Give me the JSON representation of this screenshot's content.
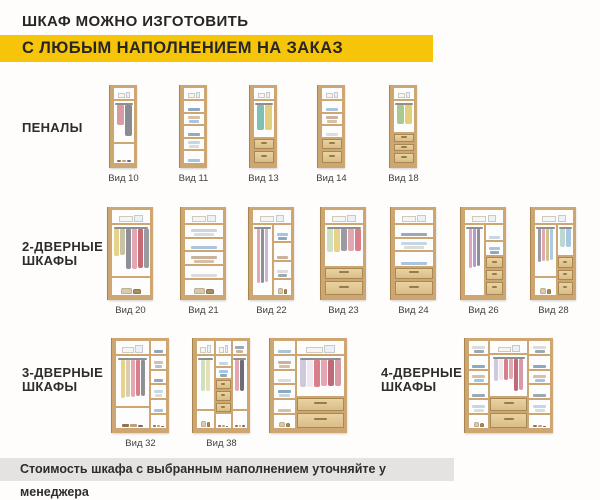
{
  "header": {
    "line1": "ШКАФ МОЖНО ИЗГОТОВИТЬ",
    "line2": "С ЛЮБЫМ НАПОЛНЕНИЕМ НА ЗАКАЗ",
    "highlight_color": "#f6c50a",
    "text_color": "#262626"
  },
  "footer": {
    "text": "Стоимость шкафа с выбранным наполнением уточняйте у менеджера",
    "bg": "#e4e3e1"
  },
  "groups": [
    {
      "label": "ПЕНАЛЫ"
    },
    {
      "label": "2-ДВЕРНЫЕ\nШКАФЫ"
    },
    {
      "label": "3-ДВЕРНЫЕ\nШКАФЫ"
    },
    {
      "label": "4-ДВЕРНЫЕ\nШКАФЫ"
    }
  ],
  "colors": {
    "wood": "#cda671",
    "wood_dark": "#a9854e",
    "drawer_front": "#e0c693",
    "interior": "#ffffff"
  },
  "cabinets": [
    {
      "group": "ПЕНАЛЫ",
      "label": "Вид 10",
      "cols": [
        {
          "w": 1,
          "cells": [
            {
              "t": "boxes",
              "h": 17
            },
            {
              "t": "hang",
              "h": 58,
              "colors": [
                "#d89aa4",
                "#8b8b93"
              ]
            },
            {
              "t": "shoes",
              "h": 25
            }
          ]
        }
      ]
    },
    {
      "group": "ПЕНАЛЫ",
      "label": "Вид 11",
      "cols": [
        {
          "w": 1,
          "cells": [
            {
              "t": "boxes",
              "h": 17
            },
            {
              "t": "shelf",
              "h": 17
            },
            {
              "t": "shelf",
              "h": 17
            },
            {
              "t": "shelf",
              "h": 17
            },
            {
              "t": "shelf",
              "h": 16
            },
            {
              "t": "shelf",
              "h": 16
            }
          ]
        }
      ]
    },
    {
      "group": "ПЕНАЛЫ",
      "label": "Вид 13",
      "cols": [
        {
          "w": 1,
          "cells": [
            {
              "t": "boxes",
              "h": 17
            },
            {
              "t": "hang",
              "h": 51,
              "colors": [
                "#7fc0b4",
                "#e4cf7d"
              ]
            },
            {
              "t": "drawer",
              "h": 16
            },
            {
              "t": "drawer",
              "h": 16
            }
          ]
        }
      ]
    },
    {
      "group": "ПЕНАЛЫ",
      "label": "Вид 14",
      "cols": [
        {
          "w": 1,
          "cells": [
            {
              "t": "boxes",
              "h": 17
            },
            {
              "t": "shelf",
              "h": 17
            },
            {
              "t": "shelf",
              "h": 17
            },
            {
              "t": "shelf",
              "h": 17
            },
            {
              "t": "drawer",
              "h": 16
            },
            {
              "t": "drawer",
              "h": 16
            }
          ]
        }
      ]
    },
    {
      "group": "ПЕНАЛЫ",
      "label": "Вид 18",
      "cols": [
        {
          "w": 1,
          "cells": [
            {
              "t": "boxes",
              "h": 17
            },
            {
              "t": "hang",
              "h": 44,
              "colors": [
                "#a9c98f",
                "#e4cf7d"
              ]
            },
            {
              "t": "drawer",
              "h": 13
            },
            {
              "t": "drawer",
              "h": 13
            },
            {
              "t": "drawer",
              "h": 13
            }
          ]
        }
      ]
    },
    {
      "group": "2-ДВЕРНЫЕ ШКАФЫ",
      "label": "Вид 20",
      "cols": [
        {
          "w": 1,
          "cells": [
            {
              "t": "boxes",
              "h": 18
            },
            {
              "t": "hang",
              "h": 62,
              "colors": [
                "#e7d28a",
                "#c9c2a6",
                "#8f8f97",
                "#e2a7b0",
                "#c86a74",
                "#9a9aa2"
              ]
            },
            {
              "t": "bags",
              "h": 20
            }
          ]
        }
      ]
    },
    {
      "group": "2-ДВЕРНЫЕ ШКАФЫ",
      "label": "Вид 21",
      "cols": [
        {
          "w": 1,
          "cells": [
            {
              "t": "boxes",
              "h": 18
            },
            {
              "t": "shelf",
              "h": 16
            },
            {
              "t": "shelf",
              "h": 16
            },
            {
              "t": "shelf",
              "h": 16
            },
            {
              "t": "shelf",
              "h": 16
            },
            {
              "t": "bags",
              "h": 18
            }
          ]
        }
      ]
    },
    {
      "group": "2-ДВЕРНЫЕ ШКАФЫ",
      "label": "Вид 22",
      "top": {
        "t": "boxes",
        "h": 18
      },
      "cols": [
        {
          "w": 0.5,
          "cells": [
            {
              "t": "hang",
              "h": 100,
              "colors": [
                "#e2a7b0",
                "#8f8f97",
                "#c9b6d6"
              ]
            }
          ]
        },
        {
          "w": 0.5,
          "cells": [
            {
              "t": "shelf",
              "h": 26
            },
            {
              "t": "shelf",
              "h": 26
            },
            {
              "t": "shelf",
              "h": 26
            },
            {
              "t": "bags",
              "h": 22
            }
          ]
        }
      ]
    },
    {
      "group": "2-ДВЕРНЫЕ ШКАФЫ",
      "label": "Вид 23",
      "cols": [
        {
          "w": 1,
          "cells": [
            {
              "t": "boxes",
              "h": 18
            },
            {
              "t": "hang",
              "h": 50,
              "colors": [
                "#cfe0c2",
                "#e7d28a",
                "#9a9aa2",
                "#e2a7b0",
                "#d87f8b"
              ]
            },
            {
              "t": "drawer",
              "h": 16
            },
            {
              "t": "drawer",
              "h": 16
            }
          ]
        }
      ]
    },
    {
      "group": "2-ДВЕРНЫЕ ШКАФЫ",
      "label": "Вид 24",
      "cols": [
        {
          "w": 1,
          "cells": [
            {
              "t": "boxes",
              "h": 18
            },
            {
              "t": "shelf",
              "h": 16
            },
            {
              "t": "shelf",
              "h": 16
            },
            {
              "t": "shelf",
              "h": 18
            },
            {
              "t": "drawer",
              "h": 16
            },
            {
              "t": "drawer",
              "h": 16
            }
          ]
        }
      ]
    },
    {
      "group": "2-ДВЕРНЫЕ ШКАФЫ",
      "label": "Вид 26",
      "top": {
        "t": "boxes",
        "h": 18
      },
      "cols": [
        {
          "w": 0.5,
          "cells": [
            {
              "t": "hang",
              "h": 100,
              "colors": [
                "#d8a8c0",
                "#b799c9",
                "#8f8f97"
              ]
            }
          ]
        },
        {
          "w": 0.5,
          "cells": [
            {
              "t": "shelf",
              "h": 24
            },
            {
              "t": "shelf",
              "h": 22
            },
            {
              "t": "drawer",
              "h": 18
            },
            {
              "t": "drawer",
              "h": 18
            },
            {
              "t": "drawer",
              "h": 18
            }
          ]
        }
      ]
    },
    {
      "group": "2-ДВЕРНЫЕ ШКАФЫ",
      "label": "Вид 28",
      "top": {
        "t": "boxes",
        "h": 18
      },
      "cols": [
        {
          "w": 0.55,
          "cells": [
            {
              "t": "hang",
              "h": 75,
              "colors": [
                "#9a9aa2",
                "#e2a7b0",
                "#d3c08f",
                "#aacbe0"
              ]
            },
            {
              "t": "bags",
              "h": 25
            }
          ]
        },
        {
          "w": 0.45,
          "cells": [
            {
              "t": "hang",
              "h": 46,
              "colors": [
                "#bcd8d0",
                "#a8c8e0"
              ]
            },
            {
              "t": "drawer",
              "h": 18
            },
            {
              "t": "drawer",
              "h": 18
            },
            {
              "t": "drawer",
              "h": 18
            }
          ]
        }
      ]
    },
    {
      "group": "3-ДВЕРНЫЕ ШКАФЫ",
      "label": "Вид 32",
      "cols": [
        {
          "w": 0.66,
          "cells": [
            {
              "t": "boxes",
              "h": 17
            },
            {
              "t": "hang",
              "h": 60,
              "colors": [
                "#e7d28a",
                "#d8cdb0",
                "#e2a7b0",
                "#d87f8b",
                "#8f8f97"
              ]
            },
            {
              "t": "shoes",
              "h": 23
            }
          ]
        },
        {
          "w": 0.34,
          "cells": [
            {
              "t": "shelf",
              "h": 17
            },
            {
              "t": "shelf",
              "h": 17
            },
            {
              "t": "shelf",
              "h": 17
            },
            {
              "t": "shelf",
              "h": 17
            },
            {
              "t": "shelf",
              "h": 17
            },
            {
              "t": "shoes",
              "h": 15
            }
          ]
        }
      ]
    },
    {
      "group": "3-ДВЕРНЫЕ ШКАФЫ",
      "label": "Вид 38",
      "cols": [
        {
          "w": 0.34,
          "cells": [
            {
              "t": "boxes",
              "h": 17
            },
            {
              "t": "hang",
              "h": 63,
              "colors": [
                "#cfe0c2",
                "#e4e0b0"
              ]
            },
            {
              "t": "bags",
              "h": 20
            }
          ]
        },
        {
          "w": 0.33,
          "cells": [
            {
              "t": "boxes",
              "h": 17
            },
            {
              "t": "shelf",
              "h": 14
            },
            {
              "t": "shelf",
              "h": 14
            },
            {
              "t": "drawer",
              "h": 13
            },
            {
              "t": "drawer",
              "h": 13
            },
            {
              "t": "drawer",
              "h": 13
            },
            {
              "t": "shoes",
              "h": 16
            }
          ]
        },
        {
          "w": 0.33,
          "cells": [
            {
              "t": "shelf",
              "h": 17
            },
            {
              "t": "hang",
              "h": 63,
              "colors": [
                "#e2a7b0",
                "#6d6d75"
              ]
            },
            {
              "t": "shoes",
              "h": 20
            }
          ]
        }
      ]
    },
    {
      "group": "3-ДВЕРНЫЕ ШКАФЫ",
      "label": null,
      "cols": [
        {
          "w": 0.3,
          "cells": [
            {
              "t": "shelf",
              "h": 17
            },
            {
              "t": "shelf",
              "h": 17
            },
            {
              "t": "shelf",
              "h": 17
            },
            {
              "t": "shelf",
              "h": 17
            },
            {
              "t": "shelf",
              "h": 17
            },
            {
              "t": "bags",
              "h": 15
            }
          ]
        },
        {
          "w": 0.7,
          "cells": [
            {
              "t": "boxes",
              "h": 17
            },
            {
              "t": "hang",
              "h": 49,
              "colors": [
                "#cfc9dd",
                "#efe9ef",
                "#d87f8b",
                "#e2a7b0",
                "#c06a78",
                "#d89aa4"
              ]
            },
            {
              "t": "drawer",
              "h": 17
            },
            {
              "t": "drawer",
              "h": 17
            }
          ]
        }
      ]
    },
    {
      "group": "4-ДВЕРНЫЕ ШКАФЫ",
      "label": null,
      "cols": [
        {
          "w": 0.24,
          "cells": [
            {
              "t": "shelf",
              "h": 17
            },
            {
              "t": "shelf",
              "h": 17
            },
            {
              "t": "shelf",
              "h": 17
            },
            {
              "t": "shelf",
              "h": 17
            },
            {
              "t": "shelf",
              "h": 17
            },
            {
              "t": "bags",
              "h": 15
            }
          ]
        },
        {
          "w": 0.48,
          "cells": [
            {
              "t": "boxes",
              "h": 16
            },
            {
              "t": "hang",
              "h": 50,
              "colors": [
                "#cfc9dd",
                "#efe9ef",
                "#d87f8b",
                "#e2a7b0",
                "#c06a78",
                "#d89aa4"
              ]
            },
            {
              "t": "drawer",
              "h": 17
            },
            {
              "t": "drawer",
              "h": 17
            }
          ]
        },
        {
          "w": 0.28,
          "cells": [
            {
              "t": "shelf",
              "h": 17
            },
            {
              "t": "shelf",
              "h": 17
            },
            {
              "t": "shelf",
              "h": 17
            },
            {
              "t": "shelf",
              "h": 17
            },
            {
              "t": "shelf",
              "h": 17
            },
            {
              "t": "shoes",
              "h": 15
            }
          ]
        }
      ]
    }
  ]
}
